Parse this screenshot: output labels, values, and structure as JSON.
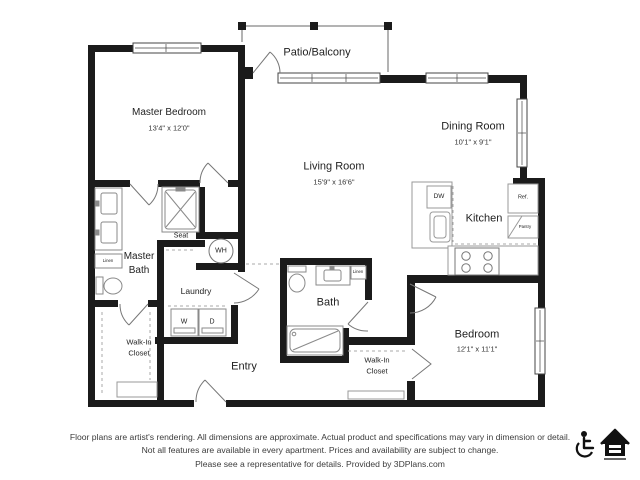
{
  "floorplan": {
    "rooms": {
      "master_bedroom": {
        "name": "Master Bedroom",
        "dims": "13'4\" x 12'0\""
      },
      "living_room": {
        "name": "Living Room",
        "dims": "15'9\" x 16'6\""
      },
      "dining_room": {
        "name": "Dining Room",
        "dims": "10'1\" x 9'1\""
      },
      "bedroom": {
        "name": "Bedroom",
        "dims": "12'1\" x 11'1\""
      },
      "patio": {
        "name": "Patio/Balcony"
      },
      "kitchen": {
        "name": "Kitchen"
      },
      "master_bath": {
        "line1": "Master",
        "line2": "Bath"
      },
      "bath": {
        "name": "Bath"
      },
      "entry": {
        "name": "Entry"
      },
      "laundry": {
        "name": "Laundry"
      },
      "walk_in_closet_left": {
        "line1": "Walk-In",
        "line2": "Closet"
      },
      "walk_in_closet_right": {
        "line1": "Walk-In",
        "line2": "Closet"
      }
    },
    "fixtures": {
      "seat": "Seat",
      "water_heater": "WH",
      "washer": "W",
      "dryer": "D",
      "dishwasher": "DW",
      "refrigerator": "Ref.",
      "pantry": "Pantry",
      "linen_master": "Linen",
      "linen_bath": "Linen"
    },
    "colors": {
      "wall": "#1b1b1b",
      "fixture_line": "#8a8a8a",
      "text": "#222222"
    }
  },
  "footer": {
    "line1": "Floor plans are artist's rendering. All dimensions are approximate. Actual product and specifications may vary in dimension or detail.",
    "line2": "Not all features are available in every apartment. Prices and availability are subject to change.",
    "line3": "Please see a representative for details. Provided by 3DPlans.com",
    "icons": [
      "accessible-icon",
      "equal-housing-icon"
    ]
  }
}
